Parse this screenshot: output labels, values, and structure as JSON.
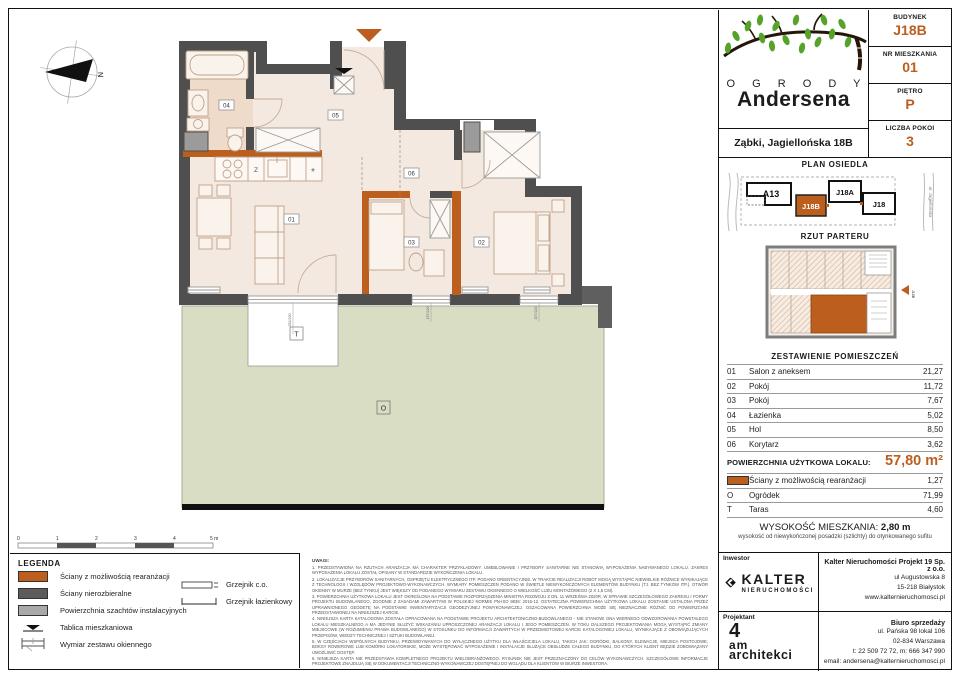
{
  "colors": {
    "accent": "#bb5e1e",
    "wall": "#4f4f4f",
    "garden": "#d9ddc3",
    "floor": "#f4e9e0",
    "bath_floor": "#efdbc9"
  },
  "header": {
    "brand_top": "O G R O D Y",
    "brand_bottom": "Andersena",
    "address": "Ząbki, Jagiellońska 18B",
    "building_label": "BUDYNEK",
    "building": "J18B",
    "apartment_label": "NR MIESZKANIA",
    "apartment": "01",
    "floor_label": "PIĘTRO",
    "floor": "P",
    "rooms_label": "LICZBA POKOI",
    "rooms": "3"
  },
  "site_plan": {
    "title": "PLAN OSIEDLA",
    "b1": "A13",
    "b2": "J18B",
    "b3": "J18A",
    "b4": "J18",
    "street_right": "ul. Jagiellońska"
  },
  "floor_overview": {
    "title": "RZUT PARTERU",
    "marker": "J18B"
  },
  "plan": {
    "labels": {
      "r01": "01",
      "r02": "02",
      "r03": "03",
      "r04": "04",
      "r05": "05",
      "r06": "06",
      "taras": "T",
      "garden": "O",
      "sink": "Z",
      "fridge": "*",
      "north": "N"
    },
    "dims": {
      "d1": "252/230",
      "d2": "157/220",
      "d3": "157/220"
    },
    "scale": {
      "s0": "0",
      "s1": "1",
      "s2": "2",
      "s3": "3",
      "s4": "4",
      "s5": "5 m"
    }
  },
  "rooms_table": {
    "title": "ZESTAWIENIE POMIESZCZEŃ",
    "rows": [
      {
        "no": "01",
        "name": "Salon z aneksem",
        "area": "21,27"
      },
      {
        "no": "02",
        "name": "Pokój",
        "area": "11,72"
      },
      {
        "no": "03",
        "name": "Pokój",
        "area": "7,67"
      },
      {
        "no": "04",
        "name": "Łazienka",
        "area": "5,02"
      },
      {
        "no": "05",
        "name": "Hol",
        "area": "8,50"
      },
      {
        "no": "06",
        "name": "Korytarz",
        "area": "3,62"
      }
    ],
    "total_label": "POWIERZCHNIA UŻYTKOWA LOKALU:",
    "total_value": "57,80 m²",
    "extra_walls": {
      "name": "Ściany z możliwością rearanżacji",
      "area": "1,27"
    },
    "extra_garden": {
      "symbol": "O",
      "name": "Ogródek",
      "area": "71,99"
    },
    "extra_terrace": {
      "symbol": "T",
      "name": "Taras",
      "area": "4,60"
    }
  },
  "height_note": {
    "label": "WYSOKOŚĆ MIESZKANIA:",
    "value": "2,80 m",
    "sub": "wysokość od niewykończonej posadzki (szlichty) do otynkowanego sufitu"
  },
  "legend": {
    "title": "LEGENDA",
    "walls_re": "Ściany z możliwością rearanżacji",
    "walls_fixed": "Ściany nierozbieralne",
    "shafts": "Powierzchnia szachtów instalacyjnych",
    "board": "Tablica mieszkaniowa",
    "window_dim": "Wymiar zestawu okiennego",
    "radiator": "Grzejnik c.o.",
    "radiator_bath": "Grzejnik łazienkowy"
  },
  "notes": {
    "title": "UWAGI:",
    "items": [
      "1. PRZEDSTAWIONA NA RZUTACH ARANŻACJA MA CHARAKTER PRZYKŁADOWY. UMEBLOWANIE I PRZYBORY SANITARNE NIE STANOWIĄ WYPOSAŻENIA NABYWANEGO LOKALU. ZAKRES WYPOSAŻENIA LOKALU ZOSTAŁ OPISANY W STANDARDZIE WYKOŃCZENIA LOKALU.",
      "2. LOKALIZACJE PRZYBORÓW SANITARNYCH, OSPRZĘTU ELEKTRYCZNEGO ITP. PODANO ORIENTACYJNIE. W TRAKCIE REALIZACJI ROBÓT MOGĄ WYSTĄPIĆ NIEWIELKIE RÓŻNICE WYNIKAJĄCE Z TECHNOLOGII I WZGLĘDÓW PROJEKTOWO-WYKONAWCZYCH. WYMIARY POMIESZCZEŃ PODANO W ŚWIETLE NIEWYKOŃCZONYCH ELEMENTÓW BUDYNKU (TJ. BEZ TYNKÓW ITP.). OTWÓR OKIENNY W MURZE (BEZ TYNKU) JEST WIĘKSZY OD PODANEGO WYMIARU ZESTAWU OKIENNEGO O WIELKOŚĆ LUZU MONTAŻOWEGO (2 X 1,5 CM).",
      "3. POWIERZCHNIA UŻYTKOWA LOKALU JEST OKREŚLONA NA PODSTAWIE ROZPORZĄDZENIA MINISTRA ROZWOJU Z DN. 11 WRZEŚNIA 2020R. W SPRAWIE SZCZEGÓŁOWEGO ZAKRESU I FORMY PROJEKTU BUDOWLANEGO, ZGODNIE Z ZASADAMI ZAWARTYMI W POLSKIEJ NORMIE PN-ISO 9836: 2015-12. OSTATECZNA POWIERZCHNIA UŻYTKOWA LOKALU ZOSTANIE USTALONA PRZEZ UPRAWNIONEGO GEODETĘ NA PODSTAWIE INWENTARYZACJI GEODEZYJNEJ POWYKONAWCZEJ. OSZACOWANA POWIERZCHNIA MOŻE SIĘ NIEZNACZNIE RÓŻNIĆ OD POWIERZCHNI PRZEDSTAWIONEJ NA NINIEJSZEJ KARCIE.",
      "4. NINIEJSZA KARTA KATALOGOWA ZOSTAŁA OPRACOWANA NA PODSTAWIE PROJEKTU ARCHITEKTONICZNO-BUDOWLANEGO - NIE STANOWI ONA WIERNEGO ODWZOROWANIA POWSTAŁEGO LOKALU MIESZKALNEGO A MA JEDYNIE SŁUŻYĆ WSKAZANIU UPROSZCZONEJ ARANŻACJI LOKALU I JEGO POMIESZCZEŃ. W TOKU DALSZEGO PROJEKTOWANIA MOGĄ WYSTĄPIĆ ZMIANY MIEJSCOWE (W ROZUMIENIU PRAWA BUDOWLANEGO) W STOSUNKU DO INFORMACJI ZAWARTYCH W PRZEDMIOTOWEJ KARCIE KATALOGOWEJ LOKALU, WYNIKAJĄCE Z OBOWIĄZUJĄCYCH PRZEPISÓW, WIEDZY TECHNICZNEJ I SZTUKI BUDOWLANEJ.",
      "5. W CZĘŚCIACH WSPÓLNYCH BUDYNKU, PRZEWIDYWANYCH DO WYŁĄCZNEGO UŻYTKU DLA WŁAŚCICIELA LOKALU, TAKICH JAK: OGRÓDKI, BALKONY, ELEWACJE, MIEJSCA POSTOJOWE, BOKSY ROWEROWE LUB KOMÓRKI LOKATORSKIE, MOŻE WYSTĘPOWAĆ WYPOSAŻENIE I INSTALACJE SŁUŻĄCE OBSŁUDZE CAŁEGO BUDYNKU, DO KTÓRYCH KLIENT BĘDZIE ZOBOWIĄZANY UMOŻLIWIĆ DOSTĘP.",
      "6. NINIEJSZA KARTA NIE PRZEDSTAWIA KOMPLETNEGO PROJEKTU WIELOBRANŻOWEGO. RYSUNEK NIE JEST PRZEZNACZONY DO CELÓW WYKONAWCZYCH. SZCZEGÓŁOWE INFORMACJE PROJEKTOWE ZNAJDUJĄ SIĘ W DOKUMENTACJI TECHNICZNO-WYKONAWCZEJ DOSTĘPNEJ DO WGLĄDU DLA KLIENTÓW W BIURZE INWESTORA.",
      "7. PROJEKT CHRONIONY PRAWEM AUTORSKIM."
    ]
  },
  "footer": {
    "investor_label": "Inwestor",
    "investor_name": "KALTER",
    "investor_sub": "NIERUCHOMOŚCI",
    "company": "Kalter Nieruchomości Projekt 19 Sp. z o.o.",
    "company_addr1": "ul Augustowska 8",
    "company_addr2": "15-218 Białystok",
    "company_web": "www.kalternieruchomosci.pl",
    "designer_label": "Projektant",
    "designer_1": "4",
    "designer_2": "am",
    "designer_3": "architekci",
    "sales_label": "Biuro sprzedaży",
    "sales_addr1": "ul. Pańska 98 lokal 106",
    "sales_addr2": "02-834 Warszawa",
    "sales_phone": "t: 22 509 72 72, m: 666 347 990",
    "sales_email": "email: andersena@kalternieruchomosci.pl"
  }
}
